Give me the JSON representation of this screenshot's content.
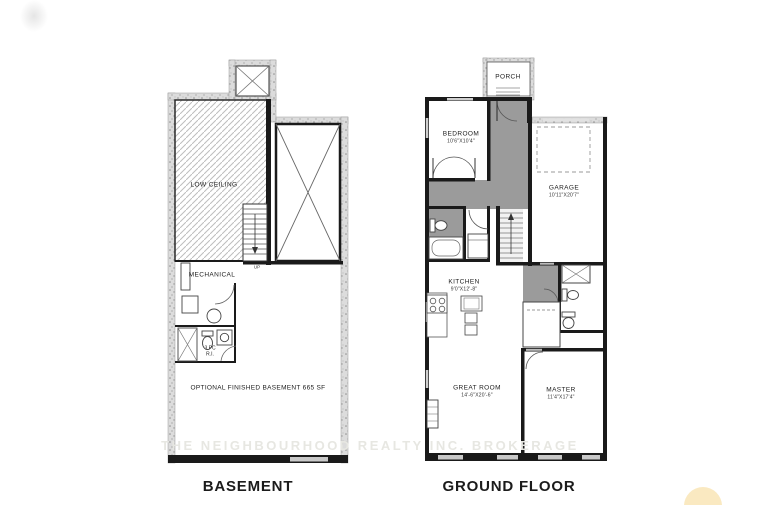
{
  "titles": {
    "basement": "BASEMENT",
    "ground_floor": "GROUND FLOOR"
  },
  "watermark": "THE NEIGHBOURHOOD REALTY INC. BROKERAGE",
  "basement": {
    "low_ceiling": "LOW CEILING",
    "mechanical": "MECHANICAL",
    "bath_line1": "3 PC",
    "bath_line2": "R.I.",
    "stairs_up": "UP",
    "note": "OPTIONAL FINISHED BASEMENT 665 SF"
  },
  "ground": {
    "porch": "PORCH",
    "bedroom_name": "BEDROOM",
    "bedroom_dims": "10'6\"X10'4\"",
    "garage_name": "GARAGE",
    "garage_dims": "10'11\"X20'7\"",
    "kitchen_name": "KITCHEN",
    "kitchen_dims": "9'0\"X12'-8\"",
    "great_room_name": "GREAT ROOM",
    "great_room_dims": "14'-6\"X20'-6\"",
    "master_name": "MASTER",
    "master_dims": "11'4\"X17'4\""
  },
  "colors": {
    "wall": "#1a1a1a",
    "gray_floor": "#9b9b9b",
    "stipple_base": "#dcdcdc",
    "hatch_line": "#bdbdbd",
    "watermark": "#e7e7e2",
    "logo_gold": "#f2c14e"
  }
}
